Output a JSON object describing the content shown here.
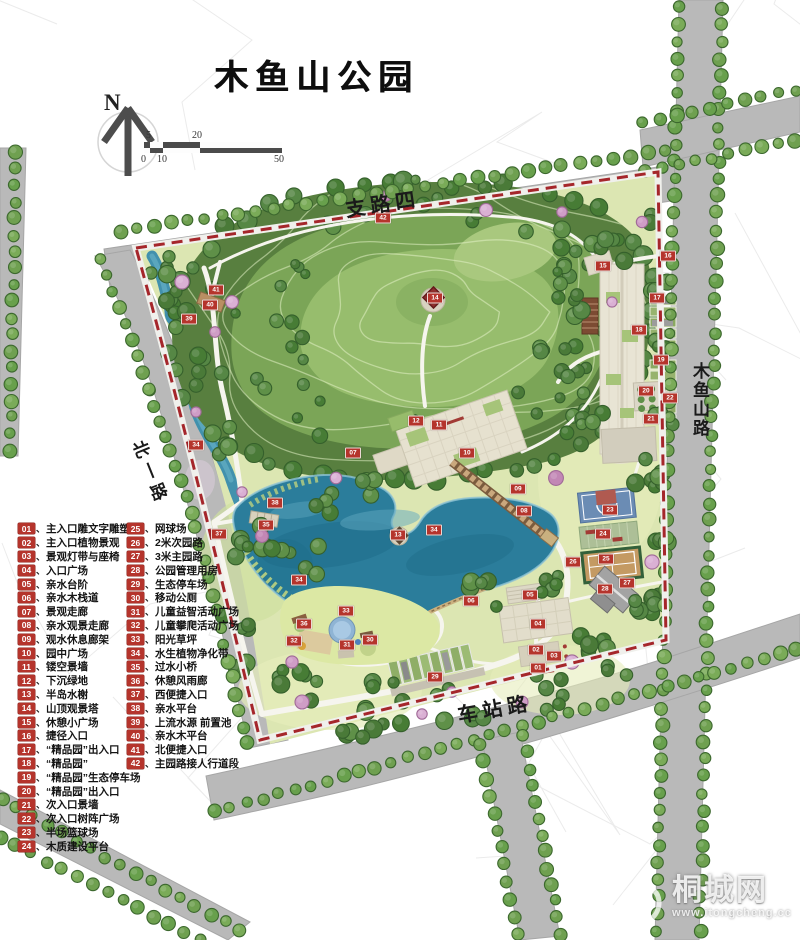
{
  "title": "木鱼山公园",
  "compass": {
    "label": "N"
  },
  "scale_bar": {
    "top_labels": [
      "5",
      "20"
    ],
    "bottom_labels": [
      "0",
      "10",
      "50"
    ]
  },
  "roads": {
    "top": "支路四",
    "left": "北一路",
    "right": "木鱼山路",
    "bottom": "车站路"
  },
  "legend": {
    "separator": "、",
    "items": [
      {
        "num": "01",
        "label": "主入口雕文字雕塑"
      },
      {
        "num": "02",
        "label": "主入口植物景观"
      },
      {
        "num": "03",
        "label": "景观灯带与座椅"
      },
      {
        "num": "04",
        "label": "入口广场"
      },
      {
        "num": "05",
        "label": "亲水台阶"
      },
      {
        "num": "06",
        "label": "亲水木栈道"
      },
      {
        "num": "07",
        "label": "景观走廊"
      },
      {
        "num": "08",
        "label": "亲水观景走廊"
      },
      {
        "num": "09",
        "label": "观水休息廊架"
      },
      {
        "num": "10",
        "label": "园中广场"
      },
      {
        "num": "11",
        "label": "镂空景墙"
      },
      {
        "num": "12",
        "label": "下沉绿地"
      },
      {
        "num": "13",
        "label": "半岛水榭"
      },
      {
        "num": "14",
        "label": "山顶观景塔"
      },
      {
        "num": "15",
        "label": "休憩小广场"
      },
      {
        "num": "16",
        "label": "捷径入口"
      },
      {
        "num": "17",
        "label": "“精品园”出入口"
      },
      {
        "num": "18",
        "label": "“精品园”"
      },
      {
        "num": "19",
        "label": "“精品园”生态停车场"
      },
      {
        "num": "20",
        "label": "“精品园”出入口"
      },
      {
        "num": "21",
        "label": "次入口景墙"
      },
      {
        "num": "22",
        "label": "次入口树阵广场"
      },
      {
        "num": "23",
        "label": "半场篮球场"
      },
      {
        "num": "24",
        "label": "木质建设平台"
      },
      {
        "num": "25",
        "label": "网球场"
      },
      {
        "num": "26",
        "label": "2米次园路"
      },
      {
        "num": "27",
        "label": "3米主园路"
      },
      {
        "num": "28",
        "label": "公园管理用房"
      },
      {
        "num": "29",
        "label": "生态停车场"
      },
      {
        "num": "30",
        "label": "移动公厕"
      },
      {
        "num": "31",
        "label": "儿童益智活动广场"
      },
      {
        "num": "32",
        "label": "儿童攀爬活动广场"
      },
      {
        "num": "33",
        "label": "阳光草坪"
      },
      {
        "num": "34",
        "label": "水生植物净化带"
      },
      {
        "num": "35",
        "label": "过水小桥"
      },
      {
        "num": "36",
        "label": "休憩风雨廊"
      },
      {
        "num": "37",
        "label": "西便捷入口"
      },
      {
        "num": "38",
        "label": "亲水平台"
      },
      {
        "num": "39",
        "label": "上流水源 前置池"
      },
      {
        "num": "40",
        "label": "亲水木平台"
      },
      {
        "num": "41",
        "label": "北便捷入口"
      },
      {
        "num": "42",
        "label": "主园路接人行道段"
      }
    ]
  },
  "markers": [
    {
      "num": "01",
      "x": 537,
      "y": 667
    },
    {
      "num": "02",
      "x": 535,
      "y": 649
    },
    {
      "num": "03",
      "x": 553,
      "y": 655
    },
    {
      "num": "04",
      "x": 537,
      "y": 623
    },
    {
      "num": "05",
      "x": 529,
      "y": 594
    },
    {
      "num": "06",
      "x": 470,
      "y": 600
    },
    {
      "num": "07",
      "x": 352,
      "y": 452
    },
    {
      "num": "08",
      "x": 523,
      "y": 510
    },
    {
      "num": "09",
      "x": 517,
      "y": 488
    },
    {
      "num": "10",
      "x": 466,
      "y": 452
    },
    {
      "num": "11",
      "x": 438,
      "y": 424
    },
    {
      "num": "12",
      "x": 415,
      "y": 420
    },
    {
      "num": "13",
      "x": 397,
      "y": 534
    },
    {
      "num": "14",
      "x": 434,
      "y": 297
    },
    {
      "num": "15",
      "x": 602,
      "y": 265
    },
    {
      "num": "16",
      "x": 667,
      "y": 255
    },
    {
      "num": "17",
      "x": 656,
      "y": 297
    },
    {
      "num": "18",
      "x": 638,
      "y": 329
    },
    {
      "num": "19",
      "x": 660,
      "y": 359
    },
    {
      "num": "20",
      "x": 645,
      "y": 390
    },
    {
      "num": "21",
      "x": 650,
      "y": 418
    },
    {
      "num": "22",
      "x": 669,
      "y": 397
    },
    {
      "num": "23",
      "x": 609,
      "y": 509
    },
    {
      "num": "24",
      "x": 602,
      "y": 533
    },
    {
      "num": "25",
      "x": 605,
      "y": 558
    },
    {
      "num": "26",
      "x": 572,
      "y": 561
    },
    {
      "num": "27",
      "x": 626,
      "y": 582
    },
    {
      "num": "28",
      "x": 604,
      "y": 588
    },
    {
      "num": "29",
      "x": 434,
      "y": 676
    },
    {
      "num": "30",
      "x": 369,
      "y": 639
    },
    {
      "num": "31",
      "x": 346,
      "y": 644
    },
    {
      "num": "32",
      "x": 293,
      "y": 640
    },
    {
      "num": "33",
      "x": 345,
      "y": 610
    },
    {
      "num": "34",
      "x": 195,
      "y": 444
    },
    {
      "num": "34",
      "x": 298,
      "y": 579
    },
    {
      "num": "34",
      "x": 433,
      "y": 529
    },
    {
      "num": "35",
      "x": 265,
      "y": 524
    },
    {
      "num": "36",
      "x": 303,
      "y": 623
    },
    {
      "num": "37",
      "x": 218,
      "y": 533
    },
    {
      "num": "38",
      "x": 274,
      "y": 502
    },
    {
      "num": "39",
      "x": 188,
      "y": 318
    },
    {
      "num": "40",
      "x": 209,
      "y": 304
    },
    {
      "num": "41",
      "x": 215,
      "y": 289
    },
    {
      "num": "42",
      "x": 382,
      "y": 217
    }
  ],
  "watermark": {
    "name": "桐城网",
    "url": "www.itongcheng.cc"
  },
  "colors": {
    "boundary": "#a5262b",
    "road": "#b9b9b9",
    "lake": "#2b7d9b",
    "marker": "#b5342c"
  }
}
